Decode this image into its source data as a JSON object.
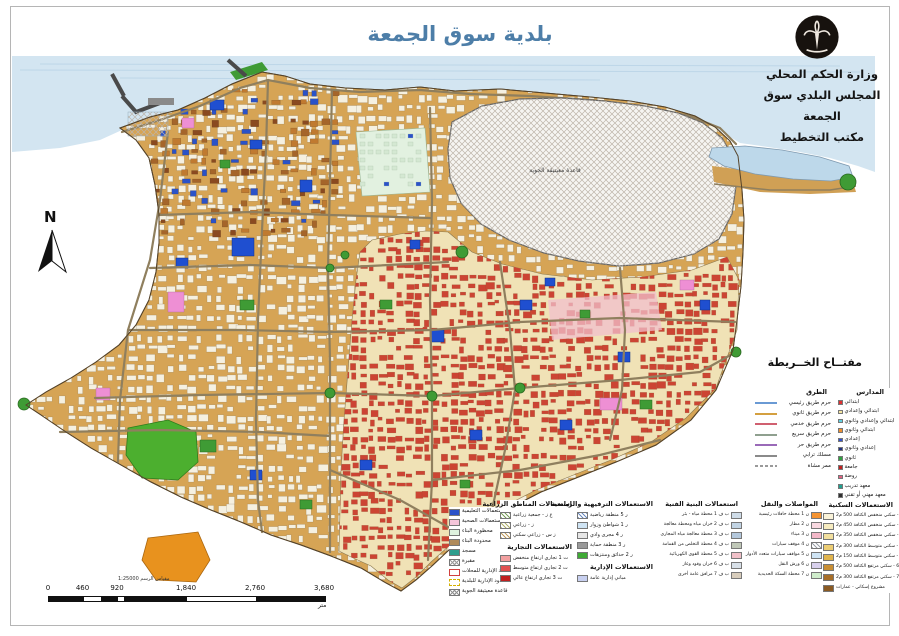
{
  "title": "بلدية سوق الجمعة",
  "org": {
    "line1": "وزارة الحكم المحلي",
    "line2": "المجلس البلدي سوق الجمعة",
    "line3": "مكتب التخطيط"
  },
  "north_label": "N",
  "map": {
    "airbase_label": "قاعدة معيتيقة الجوية"
  },
  "colors": {
    "title_blue": "#4d7ea8",
    "sea": "#d3e5f1",
    "land_west": "#d6a455",
    "land_east": "#f0e2b6",
    "airbase_fill": "#f6f5f2",
    "green": "#3f9b35",
    "orange_patch": "#e8921e"
  },
  "legend_key": {
    "title": "مفتــاح الخــريطة",
    "roads": {
      "header": "الطرق",
      "items": [
        {
          "label": "حرم طريق رئيسي",
          "color": "#6a9ad4",
          "style": "line"
        },
        {
          "label": "حرم طريق ثانوي",
          "color": "#d4a040",
          "style": "line"
        },
        {
          "label": "حرم طريق خدمي",
          "color": "#d06070",
          "style": "line"
        },
        {
          "label": "حرم طريق سريع",
          "color": "#8fa08f",
          "style": "line"
        },
        {
          "label": "حرم طريق حر",
          "color": "#9a6ab8",
          "style": "line"
        },
        {
          "label": "مسلك ترابي",
          "color": "#8a8a8a",
          "style": "line"
        },
        {
          "label": "ممر مشاة",
          "color": "#9a9a9a",
          "style": "dashed-line"
        }
      ]
    },
    "schools": {
      "header": "المدارس",
      "items": [
        {
          "label": "ابتدائي",
          "color": "#e03030",
          "style": "fill"
        },
        {
          "label": "ابتدائي وإعدادي",
          "color": "#f5e6a0",
          "style": "fill"
        },
        {
          "label": "ابتدائي وإعدادي وثانوي",
          "color": "#60d0e0",
          "style": "fill"
        },
        {
          "label": "ابتدائي وثانوي",
          "color": "#f09030",
          "style": "fill"
        },
        {
          "label": "إعدادي",
          "color": "#3050d0",
          "style": "fill"
        },
        {
          "label": "إعدادي وثانوي",
          "color": "#203080",
          "style": "fill"
        },
        {
          "label": "ثانوي",
          "color": "#30a040",
          "style": "fill"
        },
        {
          "label": "جامعة",
          "color": "#c02020",
          "style": "fill"
        },
        {
          "label": "روضة",
          "color": "#e06080",
          "style": "fill"
        },
        {
          "label": "معهد تدريب",
          "color": "#20a090",
          "style": "fill"
        },
        {
          "label": "معهد مهني أو تقني",
          "color": "#303030",
          "style": "fill"
        },
        {
          "label": "المساجد",
          "color": "#802020",
          "style": "dot"
        }
      ]
    }
  },
  "legend_bottom": {
    "general": {
      "items": [
        {
          "label": "الاستعمالات التعليمية",
          "color": "#2a52c8",
          "style": "fill"
        },
        {
          "label": "الاستعمالات الصحية",
          "color": "#f6c6da",
          "style": "fill"
        },
        {
          "label": "محظورة البناء",
          "color": "#dff2df",
          "style": "fill"
        },
        {
          "label": "محدودة البناء",
          "color": "#b08a5a",
          "style": "fill"
        },
        {
          "label": "مسجد",
          "color": "#2e9e8e",
          "style": "fill"
        },
        {
          "label": "مقبرة",
          "color": "#9a9a9a",
          "style": "crosshatch"
        },
        {
          "label": "الحدود الإدارية للمحلات",
          "color": "#d04040",
          "style": "outline"
        },
        {
          "label": "الحدود الإدارية للبلدية",
          "color": "#d4b000",
          "style": "dash-outline"
        },
        {
          "label": "قاعدة معيتيقة الجوية",
          "color": "#909090",
          "style": "crosshatch"
        }
      ]
    },
    "agriculture": {
      "header": "استعمالات المناطق الزراعية",
      "items": [
        {
          "label": "ع ز - جمعية زراعية",
          "color": "#7aa05a",
          "style": "hatch"
        },
        {
          "label": "ز - زراعي",
          "color": "#b0b06a",
          "style": "hatch"
        },
        {
          "label": "ز س - زراعي سكني",
          "color": "#c09a5a",
          "style": "hatch"
        }
      ]
    },
    "commercial": {
      "header": "الاستعمالات التجارية",
      "items": [
        {
          "label": "ت 1 تجاري ارتفاع منخفض",
          "color": "#f2a0a0",
          "style": "fill"
        },
        {
          "label": "ت 2 تجاري ارتفاع متوسط",
          "color": "#e05050",
          "style": "fill"
        },
        {
          "label": "ت 3 تجاري ارتفاع عالي",
          "color": "#c02020",
          "style": "fill"
        }
      ]
    },
    "recreation": {
      "header": "الاستعمالات الترفيهية والرياضية",
      "items": [
        {
          "label": "ر 5 منطقة رياضية",
          "color": "#6a8ac0",
          "style": "hatch"
        },
        {
          "label": "ر 1 شواطئ وزوار",
          "color": "#cfe4f4",
          "style": "fill"
        },
        {
          "label": "ر 4 مجرى وادي",
          "color": "#e6e6e6",
          "style": "fill"
        },
        {
          "label": "ر 3 منطقة حماية",
          "color": "#9a9a9a",
          "style": "fill"
        },
        {
          "label": "ر 2 حدائق ومنتزهات",
          "color": "#3faa35",
          "style": "fill"
        }
      ]
    },
    "administrative": {
      "header": "الاستعمالات الإدارية",
      "items": [
        {
          "label": "مباني إدارية عامة",
          "color": "#c8d0f0",
          "style": "fill"
        }
      ]
    },
    "infrastructure": {
      "header": "استعمالات البنية الفنية",
      "items": [
        {
          "label": "ب ف 1 محطة مياه - بئر",
          "color": "#cfdce8",
          "style": "fill"
        },
        {
          "label": "ب ف 2 خزان مياه ومحطة معالجة",
          "color": "#c2d4e4",
          "style": "fill"
        },
        {
          "label": "ب ف 3 محطة معالجة مياه المجاري",
          "color": "#b4c8dc",
          "style": "fill"
        },
        {
          "label": "ب ف 4 محطة التخلص من القمامة",
          "color": "#c0c8b8",
          "style": "fill"
        },
        {
          "label": "ب ف 5 محطة القوى الكهربائية",
          "color": "#f0c0c8",
          "style": "fill"
        },
        {
          "label": "ب ف 6 خزان وقود وغاز",
          "color": "#d8e0e8",
          "style": "fill"
        },
        {
          "label": "ب ف 7 مرافق عامة أخرى",
          "color": "#d8cdbc",
          "style": "fill"
        }
      ]
    },
    "transport": {
      "header": "المواصلات والنقل",
      "items": [
        {
          "label": "ن 1 محطة حافلات رئيسية",
          "color": "#f59433",
          "style": "fill"
        },
        {
          "label": "ن 2 مطار",
          "color": "#f8d8e0",
          "style": "fill"
        },
        {
          "label": "ن 3 ميناء",
          "color": "#f3b8c8",
          "style": "fill"
        },
        {
          "label": "ن 4 موقف سيارات",
          "color": "#9aa0a8",
          "style": "hatch"
        },
        {
          "label": "ن 5 مواقف سيارات متعدد الأدوار",
          "color": "#cfe4f4",
          "style": "fill"
        },
        {
          "label": "ن 6 ورش النقل",
          "color": "#d8d0ec",
          "style": "fill"
        },
        {
          "label": "ن 7 محطة السكة الحديدية",
          "color": "#cfeccb",
          "style": "fill"
        }
      ]
    },
    "residential": {
      "header": "الاستعمالات السكنية",
      "items": [
        {
          "label": "م ر 1 - سكني منخفض الكثافة 500 م2",
          "color": "#faf3d9",
          "style": "fill"
        },
        {
          "label": "م ر 2 - سكني منخفض الكثافة 450 م2",
          "color": "#f7ecc0",
          "style": "fill"
        },
        {
          "label": "م ر 3 - سكني منخفض الكثافة 350 م2",
          "color": "#f2df9e",
          "style": "fill"
        },
        {
          "label": "م ر 4 - سكني متوسط الكثافة 300 م2",
          "color": "#eccd74",
          "style": "fill"
        },
        {
          "label": "م ر 5 - سكني متوسط الكثافة 150 م2",
          "color": "#e0b44e",
          "style": "fill"
        },
        {
          "label": "م ر 6 - سكني مرتفع الكثافة 500 م2",
          "color": "#c98f35",
          "style": "fill"
        },
        {
          "label": "م ر 7 - سكني مرتفع الكثافة 300 م2",
          "color": "#a86f28",
          "style": "fill"
        },
        {
          "label": "مشروع إسكاني - عمارات",
          "color": "#8a5a22",
          "style": "fill"
        }
      ]
    }
  },
  "scalebar": {
    "caption": "مقياس الرسم 1:25000",
    "ticks": [
      "0",
      "460",
      "920",
      "1,840",
      "2,760",
      "3,680"
    ],
    "tick_fractions": [
      0,
      0.125,
      0.25,
      0.5,
      0.75,
      1
    ],
    "unit": "متر"
  }
}
